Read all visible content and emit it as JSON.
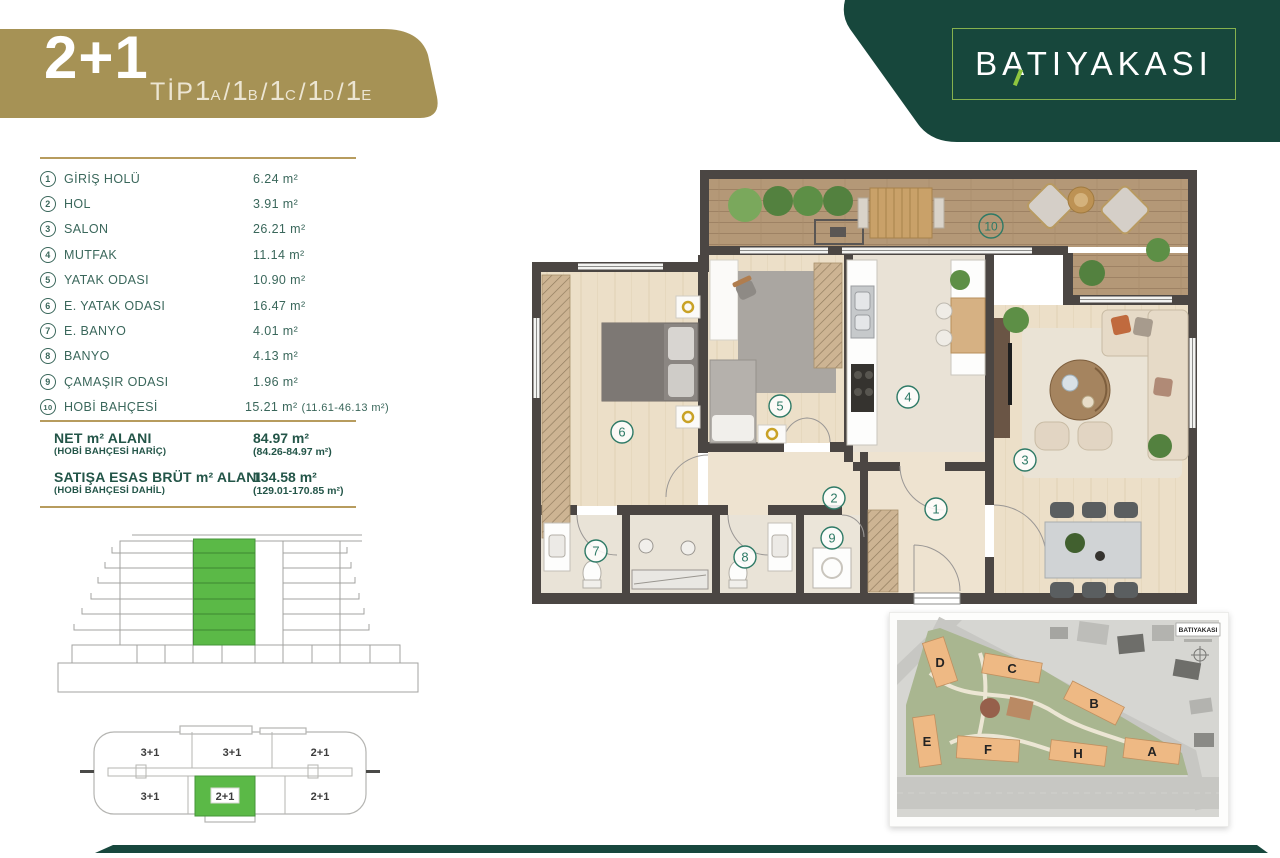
{
  "header": {
    "unit_type": "2+1",
    "tip_label": "TİP",
    "separator": "/",
    "tip_variants": [
      {
        "num": "1",
        "letter": "A"
      },
      {
        "num": "1",
        "letter": "B"
      },
      {
        "num": "1",
        "letter": "C"
      },
      {
        "num": "1",
        "letter": "D"
      },
      {
        "num": "1",
        "letter": "E"
      }
    ],
    "brand": "BATIYAKASI"
  },
  "colors": {
    "banner_gold": "#a69255",
    "brand_green": "#17473c",
    "highlight_green": "#5bb947",
    "list_teal": "#3a675b",
    "gold_line": "#b79c5e"
  },
  "room_list": {
    "rooms": [
      {
        "num": "1",
        "label": "GİRİŞ HOLÜ",
        "area": "6.24 m²"
      },
      {
        "num": "2",
        "label": "HOL",
        "area": "3.91 m²"
      },
      {
        "num": "3",
        "label": "SALON",
        "area": "26.21 m²"
      },
      {
        "num": "4",
        "label": "MUTFAK",
        "area": "11.14 m²"
      },
      {
        "num": "5",
        "label": "YATAK ODASI",
        "area": "10.90 m²"
      },
      {
        "num": "6",
        "label": "E. YATAK ODASI",
        "area": "16.47 m²"
      },
      {
        "num": "7",
        "label": "E. BANYO",
        "area": "4.01 m²"
      },
      {
        "num": "8",
        "label": "BANYO",
        "area": "4.13 m²"
      },
      {
        "num": "9",
        "label": "ÇAMAŞIR ODASI",
        "area": "1.96 m²"
      },
      {
        "num": "10",
        "label": "HOBİ BAHÇESİ",
        "area": "15.21 m²",
        "range": "(11.61-46.13 m²)"
      }
    ],
    "totals": {
      "net_label": "NET m² ALANI",
      "net_sub": "(HOBİ BAHÇESİ HARİÇ)",
      "net_value": "84.97 m²",
      "net_range": "(84.26-84.97 m²)",
      "brut_label": "SATIŞA ESAS BRÜT m² ALANI",
      "brut_sub": "(HOBİ BAHÇESİ DAHİL)",
      "brut_value": "134.58 m²",
      "brut_range": "(129.01-170.85 m²)"
    }
  },
  "plan": {
    "circles": [
      "1",
      "2",
      "3",
      "4",
      "5",
      "6",
      "7",
      "8",
      "9",
      "10"
    ]
  },
  "keyplan": {
    "units": [
      "3+1",
      "3+1",
      "2+1",
      "3+1",
      "2+1",
      "2+1"
    ],
    "highlighted_unit": "2+1"
  },
  "siteplan": {
    "buildings": [
      "D",
      "C",
      "B",
      "E",
      "F",
      "H",
      "A"
    ],
    "logo": "BATIYAKASI"
  }
}
